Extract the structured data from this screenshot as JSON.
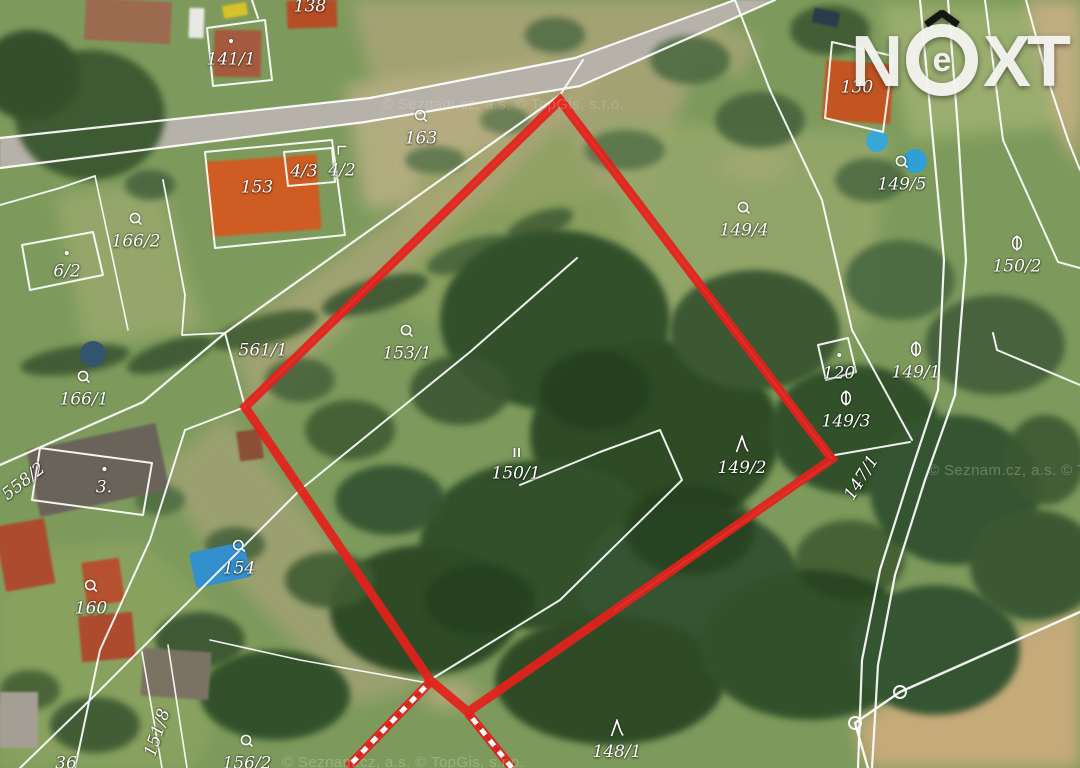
{
  "logo": {
    "n": "N",
    "e": "e",
    "x": "X",
    "t": "T"
  },
  "watermarks": [
    {
      "text": "© Seznam.cz, a.s. © TopGis, s.r.o.",
      "x": 382,
      "y": 96,
      "opacity": 0.22
    },
    {
      "text": "© Seznam.cz, a.s. © TopGis, s.r.o.",
      "x": 928,
      "y": 462,
      "opacity": 0.28
    },
    {
      "text": "© Seznam.cz, a.s. © TopGis, s.r.o.",
      "x": 282,
      "y": 754,
      "opacity": 0.28
    }
  ],
  "map": {
    "palette": {
      "base": "#7d9a5c",
      "road": "#b6b2aa",
      "line": "#ffffff",
      "red": "#e3211c",
      "stripe_red": "#d8261f"
    },
    "parcel_labels": [
      {
        "text": "138",
        "x": 310,
        "y": 7,
        "symbol": "none",
        "rot": 0
      },
      {
        "text": "141/1",
        "x": 231,
        "y": 50,
        "symbol": "dot",
        "rot": 0
      },
      {
        "text": "163",
        "x": 421,
        "y": 128,
        "symbol": "ring",
        "rot": 0
      },
      {
        "text": "4/2",
        "x": 342,
        "y": 161,
        "symbol": "corner",
        "rot": 0
      },
      {
        "text": "4/3",
        "x": 304,
        "y": 172,
        "symbol": "none",
        "rot": 0
      },
      {
        "text": "153",
        "x": 257,
        "y": 188,
        "symbol": "none",
        "rot": 0
      },
      {
        "text": "166/2",
        "x": 136,
        "y": 231,
        "symbol": "ring",
        "rot": 0
      },
      {
        "text": "6/2",
        "x": 67,
        "y": 262,
        "symbol": "dot",
        "rot": 0
      },
      {
        "text": "166/1",
        "x": 84,
        "y": 389,
        "symbol": "ring",
        "rot": 0
      },
      {
        "text": "561/1",
        "x": 263,
        "y": 351,
        "symbol": "none",
        "rot": 0
      },
      {
        "text": "153/1",
        "x": 407,
        "y": 343,
        "symbol": "ring",
        "rot": 0
      },
      {
        "text": "150/1",
        "x": 516,
        "y": 464,
        "symbol": "pause",
        "rot": 0
      },
      {
        "text": "149/4",
        "x": 744,
        "y": 220,
        "symbol": "ring",
        "rot": 0
      },
      {
        "text": "149/5",
        "x": 902,
        "y": 174,
        "symbol": "ring",
        "rot": 0
      },
      {
        "text": "130",
        "x": 857,
        "y": 88,
        "symbol": "none",
        "rot": 0
      },
      {
        "text": "150/2",
        "x": 1017,
        "y": 255,
        "symbol": "theta",
        "rot": 0
      },
      {
        "text": "149/1",
        "x": 916,
        "y": 361,
        "symbol": "theta",
        "rot": 0
      },
      {
        "text": "120",
        "x": 839,
        "y": 364,
        "symbol": "dot",
        "rot": 0
      },
      {
        "text": "149/3",
        "x": 846,
        "y": 410,
        "symbol": "theta",
        "rot": 0
      },
      {
        "text": "149/2",
        "x": 742,
        "y": 456,
        "symbol": "lambda",
        "rot": 0
      },
      {
        "text": "147/1",
        "x": 862,
        "y": 478,
        "symbol": "none",
        "rot": -58
      },
      {
        "text": "558/2",
        "x": 24,
        "y": 482,
        "symbol": "none",
        "rot": -38
      },
      {
        "text": "3.",
        "x": 104,
        "y": 478,
        "symbol": "dot",
        "rot": 0
      },
      {
        "text": "154",
        "x": 239,
        "y": 558,
        "symbol": "ring",
        "rot": 0
      },
      {
        "text": "160",
        "x": 91,
        "y": 598,
        "symbol": "ring",
        "rot": 0
      },
      {
        "text": "151/8",
        "x": 158,
        "y": 733,
        "symbol": "none",
        "rot": -72
      },
      {
        "text": "156/2",
        "x": 247,
        "y": 753,
        "symbol": "ring",
        "rot": 0
      },
      {
        "text": "148/1",
        "x": 617,
        "y": 740,
        "symbol": "lambda",
        "rot": 0
      },
      {
        "text": "36",
        "x": 66,
        "y": 764,
        "symbol": "none",
        "rot": 0
      }
    ],
    "red_polygon": {
      "points": "560,100 832,459 468,712 430,680 245,407",
      "width": 9
    },
    "striped_paths": [
      {
        "points": "430,682 348,767"
      },
      {
        "points": "468,713 512,768"
      }
    ],
    "roads": [
      {
        "pts": "0,138 370,98 575,58 735,0 775,0 580,86 365,122 0,168",
        "fill": "#b6b2aa",
        "op": 1
      }
    ],
    "patches": [
      {
        "pts": "350,0 720,0 650,190 410,215",
        "fill": "#a9a478",
        "op": 0.85
      },
      {
        "pts": "345,85 550,60 505,200 365,210",
        "fill": "#b6ae82",
        "op": 0.9
      },
      {
        "pts": "600,120 890,135 865,330 640,330",
        "fill": "#95a76a",
        "op": 0.9
      },
      {
        "pts": "880,5 1080,10 1080,125 910,140",
        "fill": "#9cb070",
        "op": 0.9
      },
      {
        "pts": "420,175 560,120 650,265 470,340 385,300",
        "fill": "#8da160",
        "op": 0.8
      },
      {
        "pts": "225,415 330,540 420,685 355,705 215,560 160,470",
        "fill": "#a3a274",
        "op": 0.8
      },
      {
        "pts": "1080,600 900,690 855,725 868,768 1080,768",
        "fill": "#c9ab7c",
        "op": 0.95
      },
      {
        "pts": "1026,0 1080,0 1080,168 1060,135",
        "fill": "#c4ad82",
        "op": 0.9
      },
      {
        "pts": "55,195 160,182 205,330 85,345",
        "fill": "#9cab6e",
        "op": 0.75
      },
      {
        "pts": "0,555 140,540 255,645 195,768 0,768",
        "fill": "#8ba361",
        "op": 0.8
      },
      {
        "pts": "228,336 565,93 592,70 604,86 256,410",
        "fill": "#b1a77c",
        "op": 0.65
      },
      {
        "pts": "700,10 760,40 740,80 690,45",
        "fill": "#b3a87c",
        "op": 0.6
      },
      {
        "cx": 450,
        "cy": 695,
        "rx": 28,
        "ry": 14,
        "fill": "#b9ab80",
        "op": 0.8
      },
      {
        "cx": 755,
        "cy": 165,
        "rx": 35,
        "ry": 16,
        "fill": "#a8ab76",
        "op": 0.6
      }
    ],
    "trees": [
      {
        "cx": 90,
        "cy": 115,
        "rx": 75,
        "ry": 65,
        "fill": "#3d5a33",
        "op": 1
      },
      {
        "cx": 30,
        "cy": 75,
        "rx": 50,
        "ry": 45,
        "fill": "#345029",
        "op": 1
      },
      {
        "cx": 150,
        "cy": 185,
        "rx": 25,
        "ry": 15,
        "fill": "#46633c",
        "op": 0.9
      },
      {
        "cx": 435,
        "cy": 160,
        "rx": 30,
        "ry": 14,
        "fill": "#526f46",
        "op": 0.8
      },
      {
        "cx": 75,
        "cy": 360,
        "rx": 55,
        "ry": 14,
        "fill": "#3a5730",
        "op": 0.9,
        "rot": -8
      },
      {
        "cx": 170,
        "cy": 355,
        "rx": 45,
        "ry": 14,
        "fill": "#3a5730",
        "op": 0.9,
        "rot": -18
      },
      {
        "cx": 265,
        "cy": 330,
        "rx": 55,
        "ry": 15,
        "fill": "#3f5c33",
        "op": 0.9,
        "rot": -15
      },
      {
        "cx": 375,
        "cy": 295,
        "rx": 55,
        "ry": 16,
        "fill": "#3a5730",
        "op": 0.9,
        "rot": -16
      },
      {
        "cx": 470,
        "cy": 255,
        "rx": 45,
        "ry": 15,
        "fill": "#436038",
        "op": 0.85,
        "rot": -18
      },
      {
        "cx": 540,
        "cy": 225,
        "rx": 35,
        "ry": 13,
        "fill": "#3a5730",
        "op": 0.8,
        "rot": -20
      },
      {
        "cx": 555,
        "cy": 320,
        "rx": 115,
        "ry": 90,
        "fill": "#33512b",
        "op": 1
      },
      {
        "cx": 655,
        "cy": 435,
        "rx": 125,
        "ry": 95,
        "fill": "#2f4c28",
        "op": 1
      },
      {
        "cx": 540,
        "cy": 545,
        "rx": 120,
        "ry": 85,
        "fill": "#33512b",
        "op": 1
      },
      {
        "cx": 425,
        "cy": 610,
        "rx": 95,
        "ry": 65,
        "fill": "#2f4c28",
        "op": 1
      },
      {
        "cx": 690,
        "cy": 585,
        "rx": 110,
        "ry": 80,
        "fill": "#365430",
        "op": 1
      },
      {
        "cx": 610,
        "cy": 680,
        "rx": 115,
        "ry": 65,
        "fill": "#2f4c28",
        "op": 1
      },
      {
        "cx": 810,
        "cy": 645,
        "rx": 110,
        "ry": 75,
        "fill": "#33512b",
        "op": 1
      },
      {
        "cx": 935,
        "cy": 650,
        "rx": 85,
        "ry": 65,
        "fill": "#365430",
        "op": 1
      },
      {
        "cx": 755,
        "cy": 330,
        "rx": 85,
        "ry": 60,
        "fill": "#3a5830",
        "op": 1
      },
      {
        "cx": 855,
        "cy": 430,
        "rx": 85,
        "ry": 65,
        "fill": "#33512b",
        "op": 1
      },
      {
        "cx": 955,
        "cy": 490,
        "rx": 85,
        "ry": 75,
        "fill": "#365430",
        "op": 1
      },
      {
        "cx": 1035,
        "cy": 565,
        "rx": 65,
        "ry": 55,
        "fill": "#3a5830",
        "op": 1
      },
      {
        "cx": 995,
        "cy": 345,
        "rx": 70,
        "ry": 50,
        "fill": "#44613a",
        "op": 0.95
      },
      {
        "cx": 900,
        "cy": 280,
        "rx": 55,
        "ry": 40,
        "fill": "#4a673f",
        "op": 0.9
      },
      {
        "cx": 760,
        "cy": 120,
        "rx": 45,
        "ry": 28,
        "fill": "#46633c",
        "op": 0.9
      },
      {
        "cx": 690,
        "cy": 60,
        "rx": 40,
        "ry": 24,
        "fill": "#4a673f",
        "op": 0.85
      },
      {
        "cx": 625,
        "cy": 150,
        "rx": 40,
        "ry": 20,
        "fill": "#506d44",
        "op": 0.8
      },
      {
        "cx": 870,
        "cy": 180,
        "rx": 35,
        "ry": 22,
        "fill": "#4a673f",
        "op": 0.85
      },
      {
        "cx": 595,
        "cy": 390,
        "rx": 55,
        "ry": 40,
        "fill": "#233d1d",
        "op": 0.75
      },
      {
        "cx": 690,
        "cy": 530,
        "rx": 65,
        "ry": 45,
        "fill": "#233d1d",
        "op": 0.7
      },
      {
        "cx": 480,
        "cy": 600,
        "rx": 55,
        "ry": 35,
        "fill": "#233d1d",
        "op": 0.7
      },
      {
        "cx": 850,
        "cy": 560,
        "rx": 55,
        "ry": 40,
        "fill": "#233d1d",
        "op": 0.6
      },
      {
        "cx": 275,
        "cy": 695,
        "rx": 75,
        "ry": 45,
        "fill": "#33512b",
        "op": 1
      },
      {
        "cx": 200,
        "cy": 640,
        "rx": 45,
        "ry": 28,
        "fill": "#3a5730",
        "op": 0.95
      },
      {
        "cx": 330,
        "cy": 580,
        "rx": 45,
        "ry": 28,
        "fill": "#3f5c33",
        "op": 0.9
      },
      {
        "cx": 95,
        "cy": 725,
        "rx": 45,
        "ry": 28,
        "fill": "#3a5730",
        "op": 0.9
      },
      {
        "cx": 30,
        "cy": 690,
        "rx": 30,
        "ry": 20,
        "fill": "#3f5c33",
        "op": 0.85
      },
      {
        "cx": 235,
        "cy": 545,
        "rx": 30,
        "ry": 18,
        "fill": "#44613a",
        "op": 0.85
      },
      {
        "cx": 160,
        "cy": 500,
        "rx": 25,
        "ry": 15,
        "fill": "#4a673f",
        "op": 0.8
      },
      {
        "cx": 350,
        "cy": 430,
        "rx": 45,
        "ry": 30,
        "fill": "#3f5c33",
        "op": 0.9
      },
      {
        "cx": 300,
        "cy": 380,
        "rx": 35,
        "ry": 22,
        "fill": "#44613a",
        "op": 0.85
      },
      {
        "cx": 460,
        "cy": 390,
        "rx": 50,
        "ry": 35,
        "fill": "#3a5730",
        "op": 0.9
      },
      {
        "cx": 390,
        "cy": 500,
        "rx": 55,
        "ry": 35,
        "fill": "#365430",
        "op": 0.95
      },
      {
        "cx": 555,
        "cy": 35,
        "rx": 30,
        "ry": 18,
        "fill": "#4a673f",
        "op": 0.8
      },
      {
        "cx": 505,
        "cy": 120,
        "rx": 25,
        "ry": 14,
        "fill": "#526f46",
        "op": 0.75
      },
      {
        "cx": 1045,
        "cy": 460,
        "rx": 40,
        "ry": 45,
        "fill": "#3a5830",
        "op": 0.9
      },
      {
        "cx": 830,
        "cy": 30,
        "rx": 40,
        "ry": 25,
        "fill": "#3c5831",
        "op": 0.9
      }
    ],
    "houses": [
      {
        "x": 85,
        "y": 0,
        "w": 86,
        "h": 42,
        "fill": "#9b6b50",
        "rot": 3
      },
      {
        "x": 214,
        "y": 30,
        "w": 47,
        "h": 47,
        "fill": "#a65a3e",
        "rot": 1
      },
      {
        "x": 287,
        "y": 0,
        "w": 50,
        "h": 28,
        "fill": "#b54d28",
        "rot": -2
      },
      {
        "x": 209,
        "y": 158,
        "w": 110,
        "h": 75,
        "fill": "#cf5c20",
        "rot": -4
      },
      {
        "x": 824,
        "y": 62,
        "w": 68,
        "h": 60,
        "fill": "#c25524",
        "rot": 4
      },
      {
        "x": 32,
        "y": 436,
        "w": 132,
        "h": 68,
        "fill": "#6b635a",
        "rot": -12
      },
      {
        "x": 0,
        "y": 522,
        "w": 50,
        "h": 66,
        "fill": "#ad4c2e",
        "rot": -10
      },
      {
        "x": 84,
        "y": 560,
        "w": 38,
        "h": 44,
        "fill": "#b5512e",
        "rot": -8
      },
      {
        "x": 80,
        "y": 614,
        "w": 54,
        "h": 46,
        "fill": "#ad4c2e",
        "rot": -5
      },
      {
        "x": 0,
        "y": 692,
        "w": 38,
        "h": 56,
        "fill": "#a59e94",
        "rot": 0
      },
      {
        "x": 142,
        "y": 650,
        "w": 68,
        "h": 48,
        "fill": "#7c7264",
        "rot": 4
      },
      {
        "x": 238,
        "y": 430,
        "w": 24,
        "h": 30,
        "fill": "#8b4f38",
        "rot": -8
      },
      {
        "x": 189,
        "y": 8,
        "w": 15,
        "h": 30,
        "fill": "#e8e8e4",
        "rot": 2
      },
      {
        "x": 223,
        "y": 4,
        "w": 24,
        "h": 13,
        "fill": "#d8c22a",
        "rot": -10
      },
      {
        "x": 813,
        "y": 10,
        "w": 26,
        "h": 15,
        "fill": "#2a3a4a",
        "rot": 12
      }
    ],
    "pools": [
      {
        "cx": 877,
        "cy": 141,
        "r": 11,
        "fill": "#35a8d8"
      },
      {
        "cx": 915,
        "cy": 161,
        "r": 12,
        "fill": "#2f9fd4"
      },
      {
        "cx": 93,
        "cy": 354,
        "r": 13,
        "fill": "#33566e"
      }
    ],
    "pool_rects": [
      {
        "x": 192,
        "y": 547,
        "w": 56,
        "h": 36,
        "fill": "#3390cc",
        "rot": -12
      }
    ],
    "white_lines": [
      {
        "p": "0,138 370,98 575,58 735,0",
        "w": 2.2
      },
      {
        "p": "0,168 365,122 580,86 775,0",
        "w": 2.2
      },
      {
        "p": "207,28 265,20 272,80 213,86 207,28",
        "w": 2
      },
      {
        "p": "252,0 258,18",
        "w": 2
      },
      {
        "p": "205,152 332,140 345,235 215,248 205,152",
        "w": 2
      },
      {
        "p": "284,152 332,148 335,182 288,186 284,152",
        "w": 2
      },
      {
        "p": "0,465 143,402 225,333 560,95",
        "w": 2.2
      },
      {
        "p": "560,95 583,60",
        "w": 2
      },
      {
        "p": "577,258 470,352 300,490 90,700 20,768",
        "w": 2
      },
      {
        "p": "225,333 245,407",
        "w": 2
      },
      {
        "p": "245,407 185,430",
        "w": 2
      },
      {
        "p": "185,430 150,540 100,650 75,768",
        "w": 2
      },
      {
        "p": "40,448 152,463 143,515 32,500 40,448",
        "w": 2
      },
      {
        "p": "163,180 185,295 182,335 225,333",
        "w": 1.8
      },
      {
        "p": "0,205 60,188 95,176",
        "w": 1.8
      },
      {
        "p": "22,245 93,232 103,275 30,290 22,245",
        "w": 2
      },
      {
        "p": "920,0 932,130 944,260 938,390 910,475 880,570 862,660 858,768",
        "w": 2.2
      },
      {
        "p": "948,0 958,130 966,260 955,395 925,480 895,575 878,665 872,768",
        "w": 2.2
      },
      {
        "p": "1080,612 900,692 855,723 868,768",
        "w": 2.4
      },
      {
        "p": "985,0 1003,140 1058,262 1080,268",
        "w": 2
      },
      {
        "p": "993,333 997,350 1080,385",
        "w": 2
      },
      {
        "p": "1026,0 1048,80 1068,140 1080,170",
        "w": 2
      },
      {
        "p": "832,42 893,56 883,132 825,118 832,42",
        "w": 2
      },
      {
        "p": "770,90 822,200 852,330 912,440",
        "w": 2
      },
      {
        "p": "735,0 770,90",
        "w": 2
      },
      {
        "p": "818,345 848,338 856,372 826,380 818,345",
        "w": 2
      },
      {
        "p": "520,485 600,452 660,430 682,480 560,600 430,680",
        "w": 2
      },
      {
        "p": "835,455 910,442",
        "w": 2
      },
      {
        "p": "615,610 830,462",
        "w": 1.6
      },
      {
        "p": "95,176 112,255 128,330",
        "w": 1.6
      },
      {
        "p": "210,640 300,660 428,683",
        "w": 1.6
      },
      {
        "p": "142,652 162,768",
        "w": 1.6
      },
      {
        "p": "168,645 187,768",
        "w": 1.6
      },
      {
        "p": "245,407 560,100",
        "w": 1.5
      },
      {
        "p": "560,100 832,459",
        "w": 1.5
      }
    ],
    "boundary_markers": [
      {
        "cx": 900,
        "cy": 692,
        "r": 6
      },
      {
        "cx": 855,
        "cy": 723,
        "r": 6
      }
    ]
  }
}
